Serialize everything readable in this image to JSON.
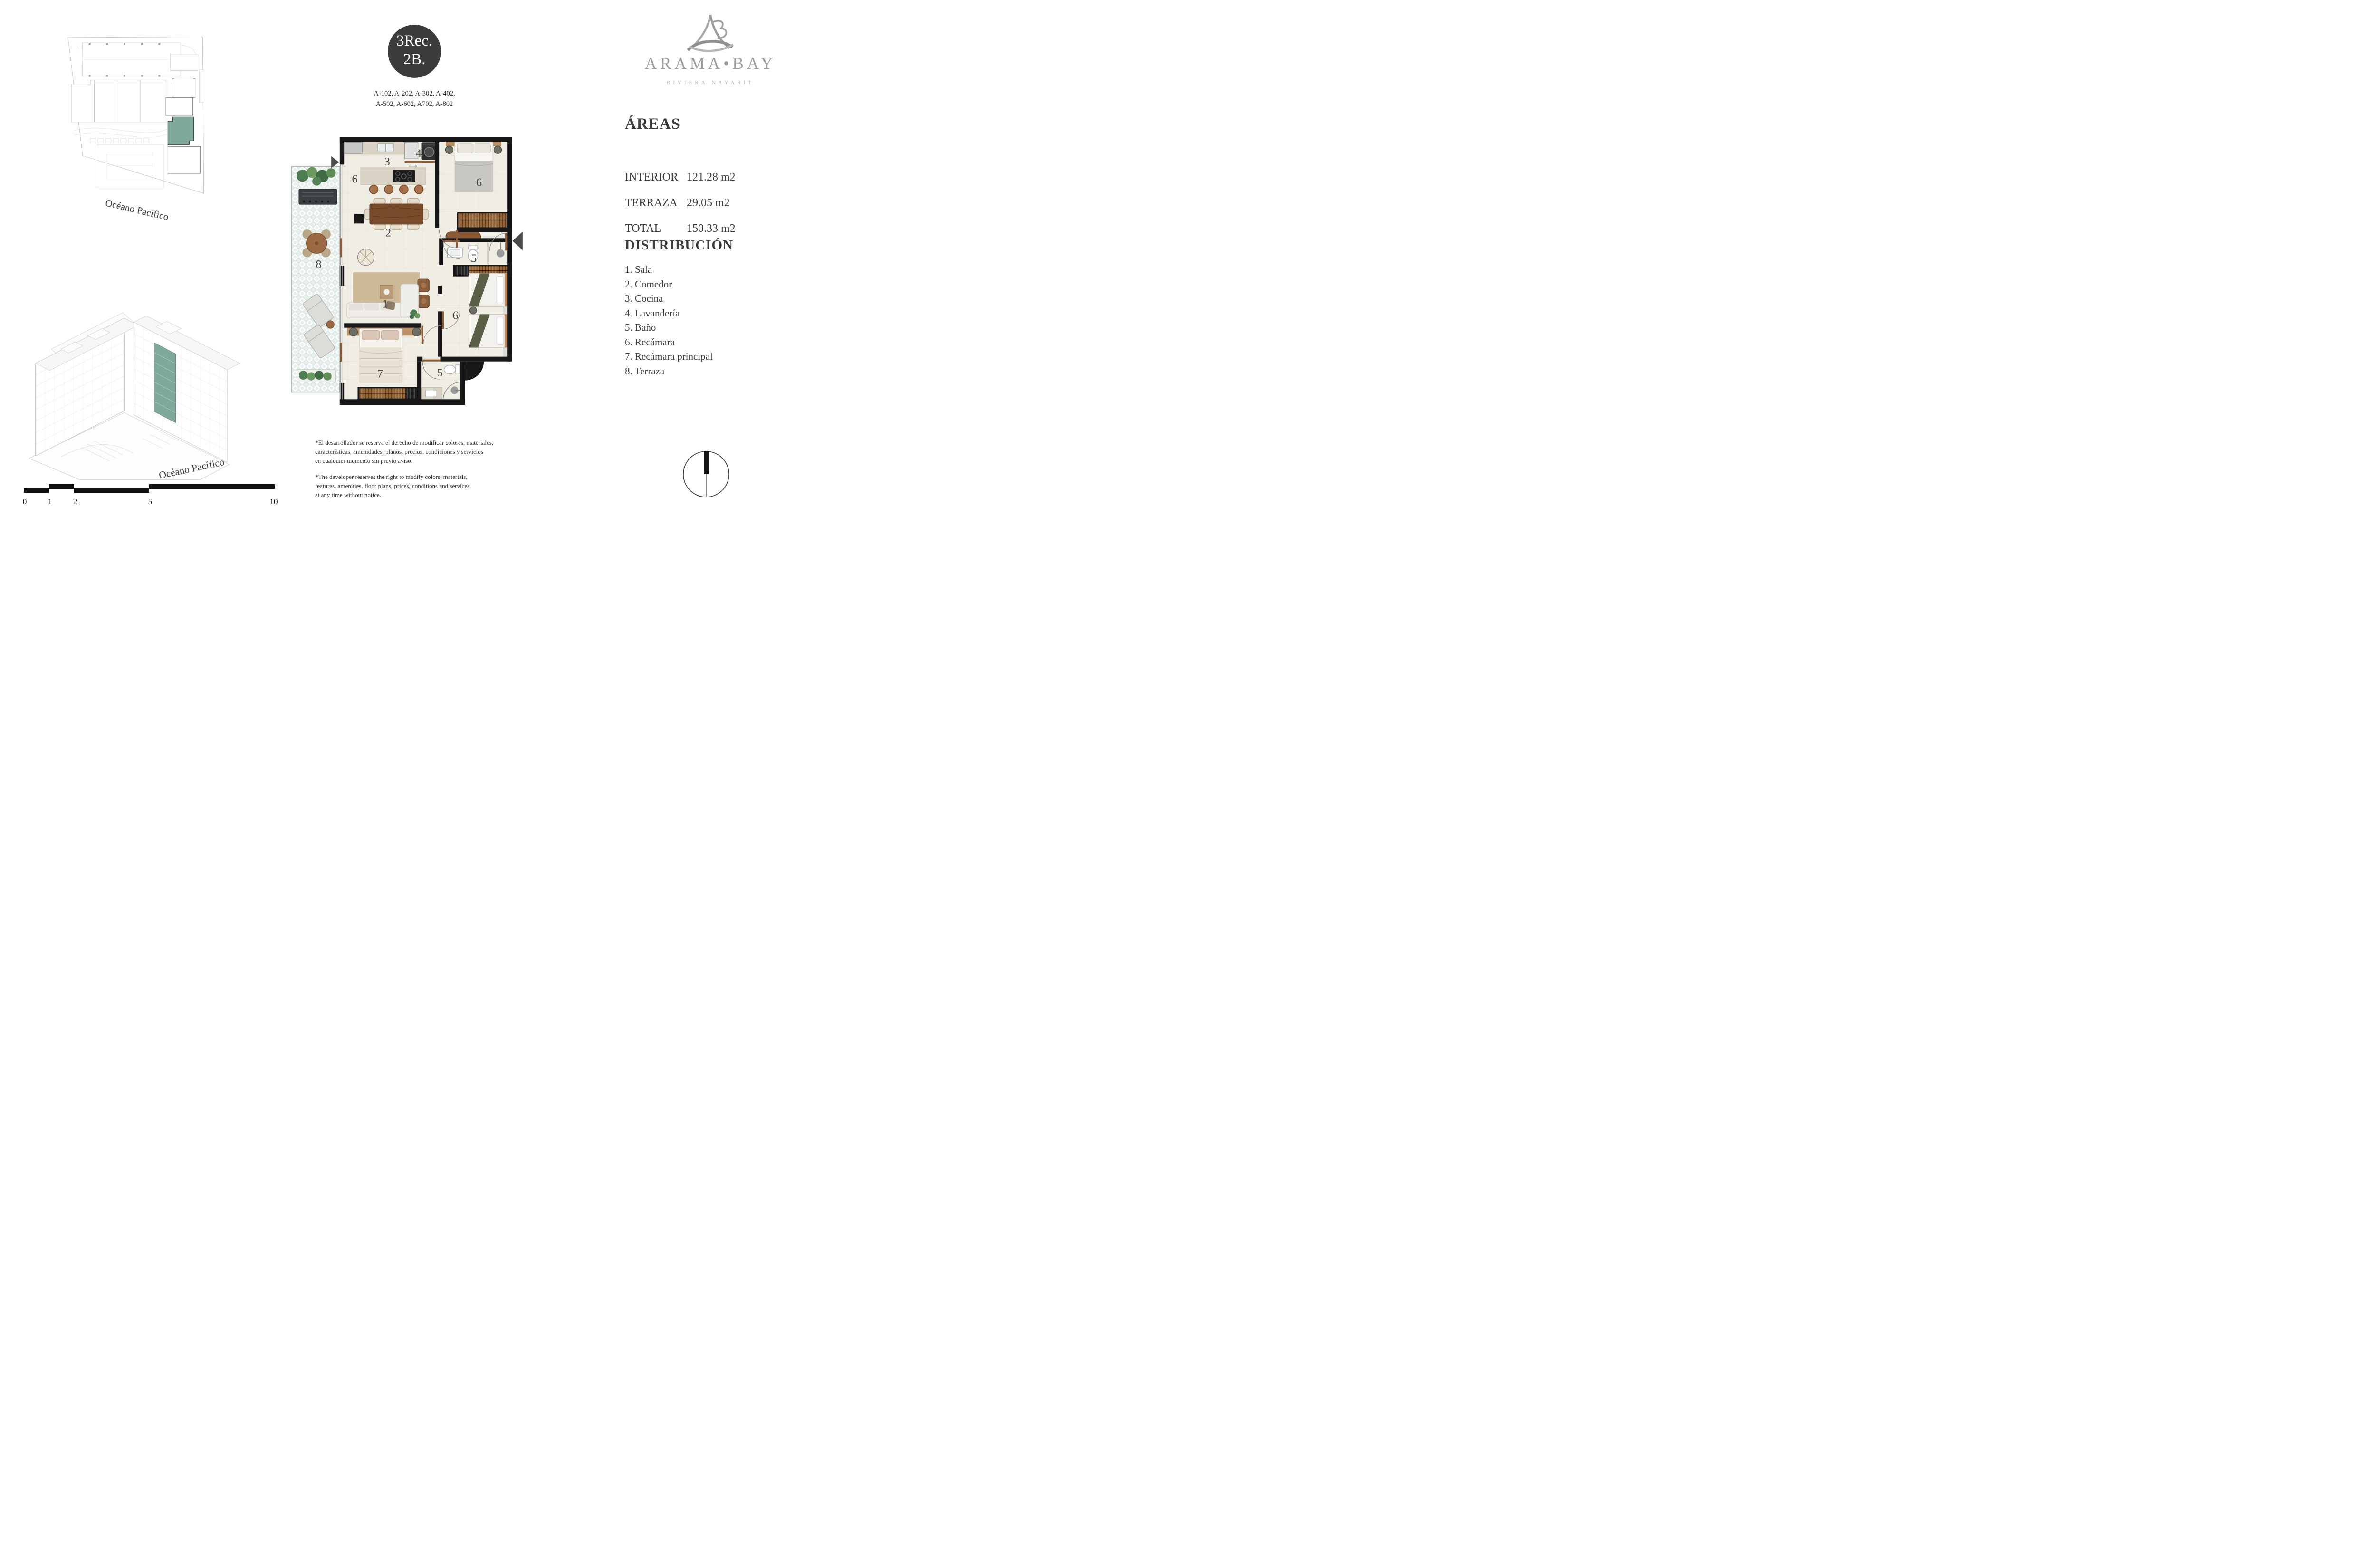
{
  "badge": {
    "line1": "3Rec.",
    "line2": "2B.",
    "bg": "#3b3b3b"
  },
  "unit_list": {
    "line1": "A-102, A-202, A-302, A-402,",
    "line2": "A-502, A-602, A702, A-802"
  },
  "brand": {
    "wordmark": "ARAMA•BAY",
    "tagline": "RIVIERA NAYARIT",
    "color": "#9b9b9b"
  },
  "areas": {
    "title": "ÁREAS",
    "rows": [
      {
        "label": "INTERIOR",
        "value": "121.28 m2"
      },
      {
        "label": "TERRAZA",
        "value": "29.05 m2"
      },
      {
        "label": "TOTAL",
        "value": "150.33 m2"
      }
    ]
  },
  "distribution": {
    "title": "DISTRIBUCIÓN",
    "items": [
      "1. Sala",
      "2. Comedor",
      "3. Cocina",
      "4. Lavandería",
      "5. Baño",
      "6. Recámara",
      "7. Recámara principal",
      "8. Terraza"
    ]
  },
  "plan": {
    "accent": "#7fa99b",
    "labels": {
      "cocina": "3",
      "pasillo_cocina": "6",
      "lavanderia": "4",
      "recamara_norte": "6",
      "comedor": "2",
      "bano_central": "5",
      "terraza": "8",
      "sala": "1",
      "recamara_sur": "6",
      "recamara_principal": "7",
      "bano_sur": "5"
    }
  },
  "site_plan": {
    "ocean_label": "Océano Pacífico"
  },
  "building_view": {
    "ocean_label": "Océano Pacífico"
  },
  "scale_bar": {
    "ticks": [
      "0",
      "1",
      "2",
      "5",
      "10"
    ]
  },
  "disclaimer": {
    "es": [
      "*El desarrollador se reserva el derecho de modificar colores, materiales,",
      "características, amenidades, planos, precios, condiciones y servicios",
      "en cualquier momento sin previo aviso."
    ],
    "en": [
      "*The developer reserves the right to modify colors, materials,",
      "features, amenities, floor plans, prices, conditions and services",
      "at any time without notice."
    ]
  }
}
